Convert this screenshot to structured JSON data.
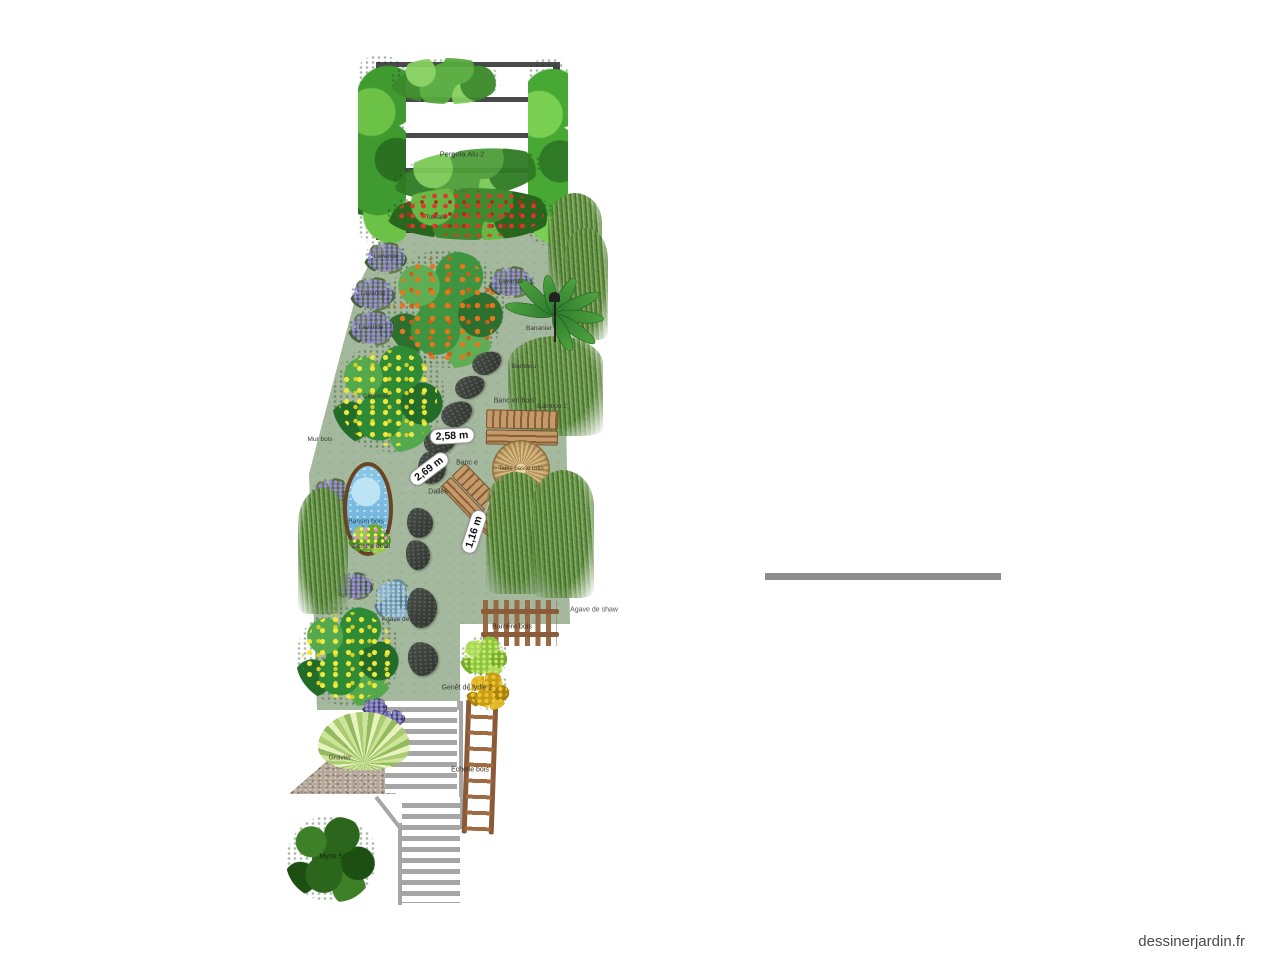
{
  "site": {
    "watermark": "dessinerjardin.fr"
  },
  "plan": {
    "pergola": {
      "label": "Pergola Alu 2"
    },
    "measurements": [
      {
        "text": "2,58 m"
      },
      {
        "text": "2,69 m"
      },
      {
        "text": "1,16 m"
      }
    ],
    "labels": [
      {
        "id": "lavande-1",
        "text": "Lavande"
      },
      {
        "id": "lavande-2",
        "text": "Lavande"
      },
      {
        "id": "lavande-3",
        "text": "Lavande"
      },
      {
        "id": "lavande-4",
        "text": "Lavande"
      },
      {
        "id": "citronnier",
        "text": "Citronnier"
      },
      {
        "id": "mur-bois",
        "text": "Mur bois"
      },
      {
        "id": "bassin-bois",
        "text": "Bassin bois"
      },
      {
        "id": "jacinthe-eau",
        "text": "Jacinthe d'eau"
      },
      {
        "id": "bambou-1",
        "text": "Bambou"
      },
      {
        "id": "bambou-2",
        "text": "Bambou 2"
      },
      {
        "id": "bananier",
        "text": "Bananier"
      },
      {
        "id": "banc-bois-1",
        "text": "Banc en bois"
      },
      {
        "id": "banc-bois-2",
        "text": "Banc e"
      },
      {
        "id": "table-rotin",
        "text": "Table basse rotin"
      },
      {
        "id": "dalles",
        "text": "Dalles"
      },
      {
        "id": "agave-shaw-1",
        "text": "Agave de shaw"
      },
      {
        "id": "agave-shaw-2",
        "text": "Agave de shaw"
      },
      {
        "id": "barriere-bois",
        "text": "Barrière bois"
      },
      {
        "id": "genet-lydie",
        "text": "Genêt de lydie 2"
      },
      {
        "id": "echelle-bois",
        "text": "Echelle bois"
      },
      {
        "id": "myrte",
        "text": "Myrte 5"
      },
      {
        "id": "gravier",
        "text": "Gravier"
      },
      {
        "id": "tomate",
        "text": "Tomate"
      }
    ]
  },
  "colors": {
    "lawn": "#a3b89c",
    "gravel": "#b5a799",
    "water": "#7cc0e4",
    "pond_border": "#6b4423",
    "stone": "#3c413c",
    "wood": "#c49a6a",
    "fence_wood": "#9a6a46",
    "wall_gray": "#8d8d8d",
    "stair_gray": "#a6a6a6",
    "fruit_orange": "#e8761e",
    "fruit_lemon": "#efe93e",
    "lavender": "#9a8fd2"
  }
}
